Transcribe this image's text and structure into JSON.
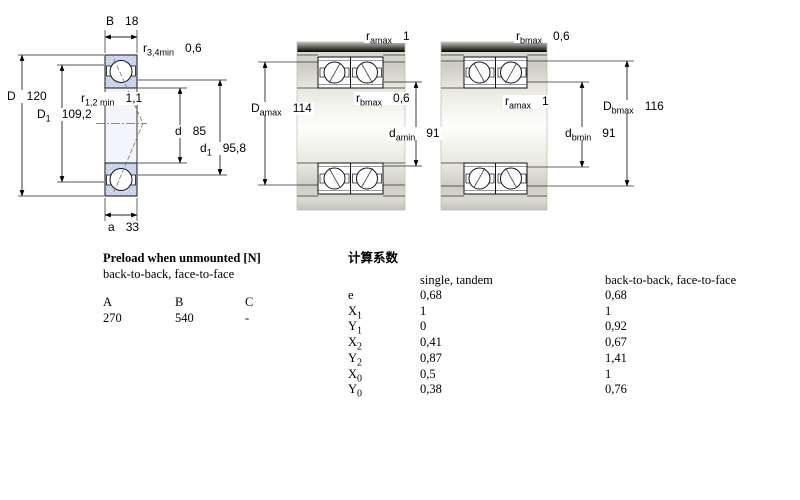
{
  "drawing": {
    "labels": {
      "b": {
        "base": "B",
        "sub": "",
        "value": "18"
      },
      "r34": {
        "base": "r",
        "sub": "3,4min",
        "value": "0,6"
      },
      "D": {
        "base": "D",
        "sub": "",
        "value": "120"
      },
      "D1": {
        "base": "D",
        "sub": "1",
        "value": "109,2"
      },
      "r12": {
        "base": "r",
        "sub": "1,2 min",
        "value": "1,1"
      },
      "d": {
        "base": "d",
        "sub": "",
        "value": "85"
      },
      "d1": {
        "base": "d",
        "sub": "1",
        "value": "95,8"
      },
      "a": {
        "base": "a",
        "sub": "",
        "value": "33"
      },
      "ramax_m": {
        "base": "r",
        "sub": "amax",
        "value": "1"
      },
      "rbmax_m": {
        "base": "r",
        "sub": "bmax",
        "value": "0,6"
      },
      "Damax": {
        "base": "D",
        "sub": "amax",
        "value": "114"
      },
      "damin": {
        "base": "d",
        "sub": "amin",
        "value": "91"
      },
      "rbmax_r": {
        "base": "r",
        "sub": "bmax",
        "value": "0,6"
      },
      "ramax_r": {
        "base": "r",
        "sub": "amax",
        "value": "1"
      },
      "Dbmax": {
        "base": "D",
        "sub": "bmax",
        "value": "116"
      },
      "dbmin": {
        "base": "d",
        "sub": "bmin",
        "value": "91"
      }
    },
    "colors": {
      "ring_fill": "#c6d1eb",
      "housing_gray": "#c9c9c1",
      "line": "#000000"
    }
  },
  "preload": {
    "title": "Preload when unmounted [N]",
    "subtitle": "back-to-back, face-to-face",
    "columns": [
      "A",
      "B",
      "C"
    ],
    "values": [
      "270",
      "540",
      "-"
    ]
  },
  "factors": {
    "title": "计算系数",
    "col1_header": "single, tandem",
    "col2_header": "back-to-back, face-to-face",
    "rows": [
      {
        "base": "e",
        "sub": "",
        "v1": "0,68",
        "v2": "0,68"
      },
      {
        "base": "X",
        "sub": "1",
        "v1": "1",
        "v2": "1"
      },
      {
        "base": "Y",
        "sub": "1",
        "v1": "0",
        "v2": "0,92"
      },
      {
        "base": "X",
        "sub": "2",
        "v1": "0,41",
        "v2": "0,67"
      },
      {
        "base": "Y",
        "sub": "2",
        "v1": "0,87",
        "v2": "1,41"
      },
      {
        "base": "X",
        "sub": "0",
        "v1": "0,5",
        "v2": "1"
      },
      {
        "base": "Y",
        "sub": "0",
        "v1": "0,38",
        "v2": "0,76"
      }
    ]
  }
}
